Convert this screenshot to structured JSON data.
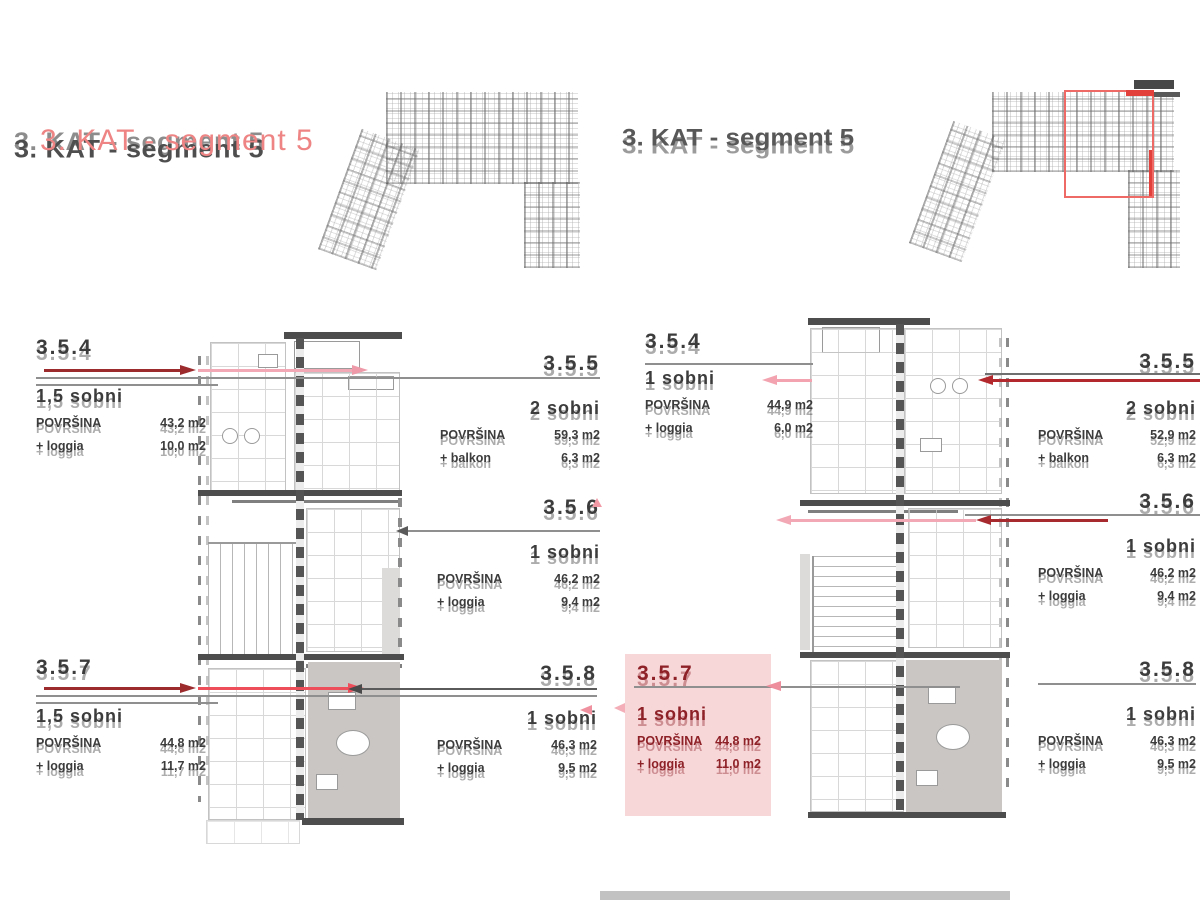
{
  "titles": {
    "left": "3. KAT - segment 5",
    "right": "3. KAT - segment 5"
  },
  "left_page": {
    "units": [
      {
        "id": "3.5.4",
        "type": "1,5 sobni",
        "area_label": "POVRŠINA",
        "area_value": "43,2 m2",
        "extra_label": "+ loggia",
        "extra_value": "10,0 m2"
      },
      {
        "id": "3.5.5",
        "type": "2 sobni",
        "area_label": "POVRŠINA",
        "area_value": "59,3 m2",
        "extra_label": "+ balkon",
        "extra_value": "6,3 m2"
      },
      {
        "id": "3.5.6",
        "type": "1 sobni",
        "area_label": "POVRŠINA",
        "area_value": "46,2 m2",
        "extra_label": "+ loggia",
        "extra_value": "9,4 m2"
      },
      {
        "id": "3.5.7",
        "type": "1,5 sobni",
        "area_label": "POVRŠINA",
        "area_value": "44,8 m2",
        "extra_label": "+ loggia",
        "extra_value": "11,7 m2"
      },
      {
        "id": "3.5.8",
        "type": "1 sobni",
        "area_label": "POVRŠINA",
        "area_value": "46,3 m2",
        "extra_label": "+ loggia",
        "extra_value": "9,5 m2"
      }
    ]
  },
  "right_page": {
    "units": [
      {
        "id": "3.5.4",
        "type": "1 sobni",
        "area_label": "POVRŠINA",
        "area_value": "44,9 m2",
        "extra_label": "+ loggia",
        "extra_value": "6,0 m2"
      },
      {
        "id": "3.5.5",
        "type": "2 sobni",
        "area_label": "POVRŠINA",
        "area_value": "52,9 m2",
        "extra_label": "+ balkon",
        "extra_value": "6,3 m2"
      },
      {
        "id": "3.5.6",
        "type": "1 sobni",
        "area_label": "POVRŠINA",
        "area_value": "46,2 m2",
        "extra_label": "+ loggia",
        "extra_value": "9,4 m2"
      },
      {
        "id": "3.5.7",
        "type": "1 sobni",
        "area_label": "POVRŠINA",
        "area_value": "44,8 m2",
        "extra_label": "+ loggia",
        "extra_value": "11,0 m2"
      },
      {
        "id": "3.5.8",
        "type": "1 sobni",
        "area_label": "POVRŠINA",
        "area_value": "46,3 m2",
        "extra_label": "+ loggia",
        "extra_value": "9,5 m2"
      }
    ]
  },
  "colors": {
    "accent_dark_red": "#9c2b2e",
    "accent_red": "#b3282c",
    "pink_arrow": "#f2a9b5",
    "highlight_box": "#f8d7d9",
    "highlight_text": "#8d2127",
    "gray_unit": "#c9c6c3",
    "title_red": "#ee8484",
    "overview_highlight": "#ee6a66"
  }
}
